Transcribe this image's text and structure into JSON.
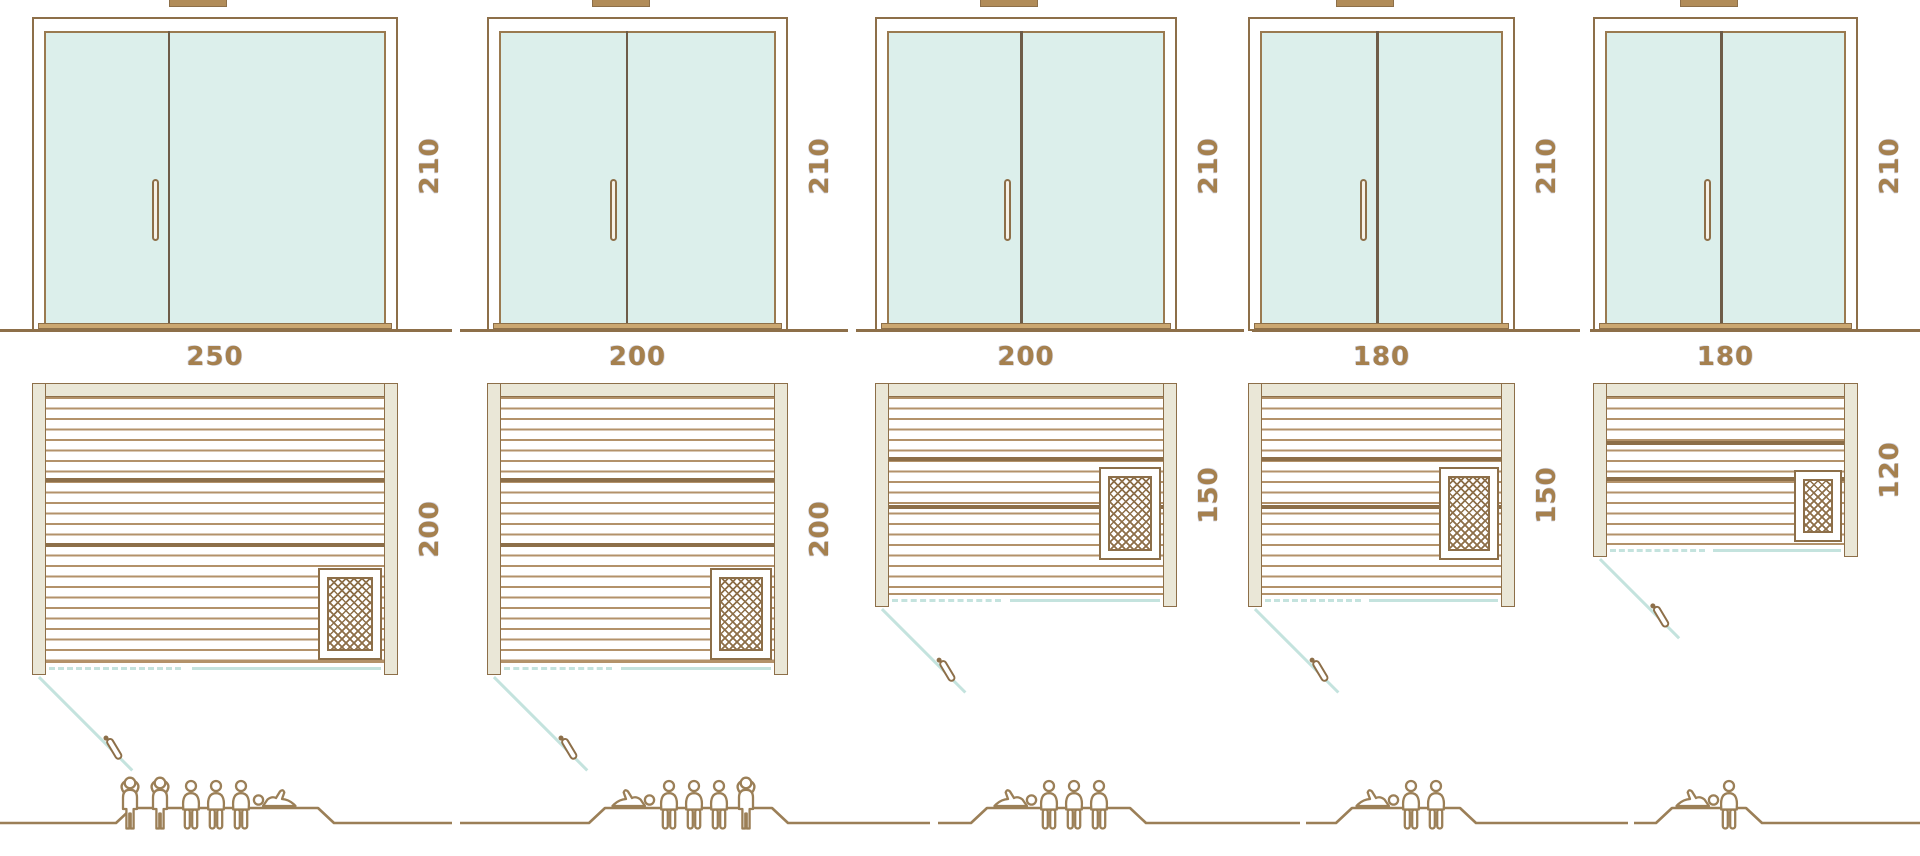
{
  "diagram": {
    "type": "sauna-size-comparison",
    "rows": [
      "front-elevation",
      "floor-plan",
      "capacity-figures"
    ],
    "colors": {
      "outline_brown": "#8d6f49",
      "slat_brown": "#b3926a",
      "wood_beige": "#eae7d7",
      "glass_mint": "#dcefeb",
      "door_swing_teal": "#c4e3de",
      "dimension_text": "#a5804e",
      "figure_brown": "#9b7f57"
    },
    "units": [
      {
        "id": "sauna-250x200",
        "elevation": {
          "height_label": "210"
        },
        "plan": {
          "width_label": "250",
          "depth_label": "200",
          "heater_position": "bottom-right"
        },
        "capacity": {
          "standing": 2,
          "sitting": 3,
          "lying": 1,
          "total": 6
        }
      },
      {
        "id": "sauna-200x200",
        "elevation": {
          "height_label": "210"
        },
        "plan": {
          "width_label": "200",
          "depth_label": "200",
          "heater_position": "bottom-right"
        },
        "capacity": {
          "standing": 1,
          "sitting": 3,
          "lying": 1,
          "total": 5
        }
      },
      {
        "id": "sauna-200x150",
        "elevation": {
          "height_label": "210"
        },
        "plan": {
          "width_label": "200",
          "depth_label": "150",
          "heater_position": "mid-right"
        },
        "capacity": {
          "standing": 0,
          "sitting": 3,
          "lying": 1,
          "total": 4
        }
      },
      {
        "id": "sauna-180x150",
        "elevation": {
          "height_label": "210"
        },
        "plan": {
          "width_label": "180",
          "depth_label": "150",
          "heater_position": "mid-right"
        },
        "capacity": {
          "standing": 0,
          "sitting": 2,
          "lying": 1,
          "total": 3
        }
      },
      {
        "id": "sauna-180x120",
        "elevation": {
          "height_label": "210"
        },
        "plan": {
          "width_label": "180",
          "depth_label": "120",
          "heater_position": "mid-right"
        },
        "capacity": {
          "standing": 0,
          "sitting": 1,
          "lying": 1,
          "total": 2
        }
      }
    ]
  }
}
